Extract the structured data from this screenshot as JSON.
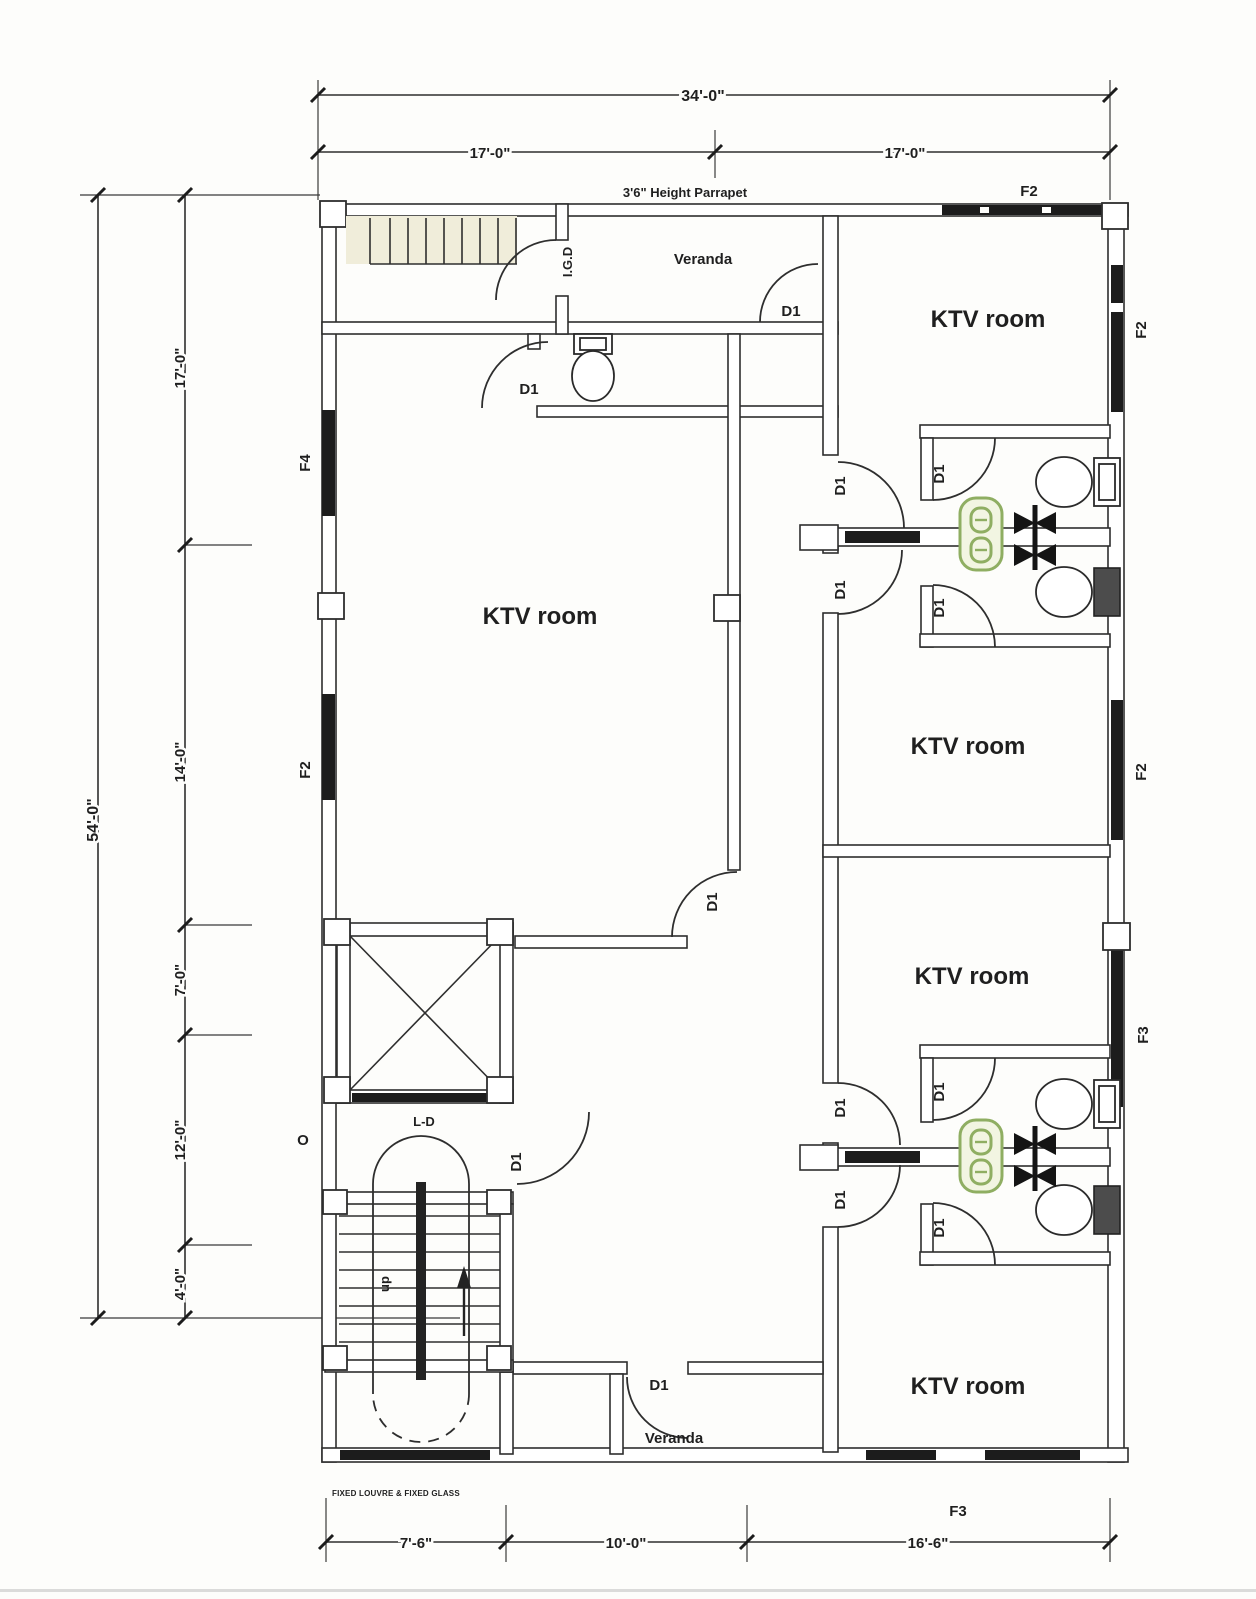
{
  "dimensions": {
    "top": {
      "overall": "34'-0\"",
      "left_half": "17'-0\"",
      "right_half": "17'-0\""
    },
    "left": {
      "overall": "54'-0\"",
      "seg1": "17'-0\"",
      "seg2": "14'-0\"",
      "seg3": "7'-0\"",
      "seg4": "12'-0\"",
      "seg5": "4'-0\""
    },
    "bottom": {
      "seg1": "7'-6\"",
      "seg2": "10'-0\"",
      "seg3": "16'-6\""
    }
  },
  "rooms": {
    "ktv": "KTV room",
    "veranda": "Veranda"
  },
  "doors": {
    "d1": "D1",
    "igd": "I.G.D",
    "lift": "L-D"
  },
  "windows": {
    "f2": "F2",
    "f3": "F3",
    "f4": "F4"
  },
  "annotations": {
    "parapet": "3'6\" Height Parrapet",
    "up": "up",
    "grid_o": "O",
    "louvre": "FIXED LOUVRE & FIXED GLASS"
  },
  "colors": {
    "line": "#2e2e2e",
    "fixture_green": "#8fae62",
    "paper": "#fdfdfb"
  }
}
